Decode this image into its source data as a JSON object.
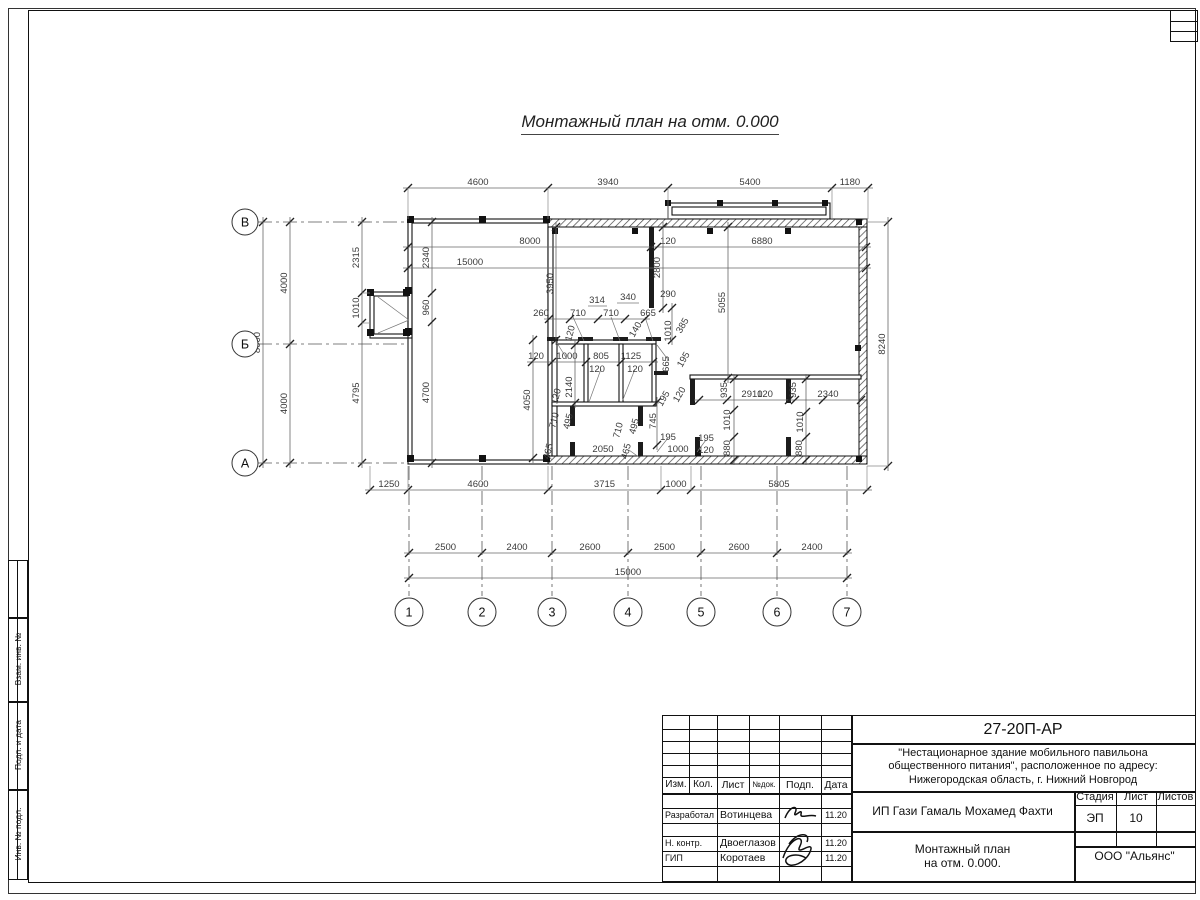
{
  "colors": {
    "line": "#111111",
    "dim_text": "#3a3a3a",
    "paper": "#ffffff"
  },
  "plan": {
    "title": "Монтажный план на отм. 0.000",
    "row_axes": [
      {
        "t": "В",
        "y": 222
      },
      {
        "t": "Б",
        "y": 344
      },
      {
        "t": "А",
        "y": 463
      }
    ],
    "col_axes": [
      {
        "t": "1",
        "x": 409
      },
      {
        "t": "2",
        "x": 482
      },
      {
        "t": "3",
        "x": 552
      },
      {
        "t": "4",
        "x": 628
      },
      {
        "t": "5",
        "x": 701
      },
      {
        "t": "6",
        "x": 777
      },
      {
        "t": "7",
        "x": 847
      }
    ],
    "chains": [
      {
        "o": "h",
        "y": 188,
        "x": [
          408,
          548,
          668,
          832,
          868
        ],
        "t": [
          "4600",
          "3940",
          "5400",
          "1180"
        ],
        "e": 31
      },
      {
        "o": "h",
        "y": 247,
        "x": [
          408,
          651,
          657,
          866
        ],
        "t": [
          "8000",
          "120",
          "6880"
        ],
        "lx": [
          530,
          668,
          762
        ]
      },
      {
        "o": "h",
        "y": 268,
        "x": [
          408,
          866
        ],
        "t": [
          "15000"
        ],
        "lx": [
          470
        ]
      },
      {
        "o": "h",
        "y": 490,
        "x": [
          370,
          408,
          548,
          661,
          691,
          867
        ],
        "t": [
          "1250",
          "4600",
          "3715",
          "1000",
          "5805"
        ],
        "e": -24
      },
      {
        "o": "h",
        "y": 553,
        "x": [
          409,
          482,
          552,
          628,
          701,
          777,
          847
        ],
        "t": [
          "2500",
          "2400",
          "2600",
          "2500",
          "2600",
          "2400"
        ]
      },
      {
        "o": "h",
        "y": 578,
        "x": [
          409,
          847
        ],
        "t": [
          "15000"
        ]
      },
      {
        "o": "h",
        "y": 319,
        "x": [
          549,
          570,
          598,
          625,
          645
        ],
        "t": [
          "260",
          "710",
          "710",
          "665"
        ],
        "lx": [
          541,
          578,
          611,
          648
        ]
      },
      {
        "o": "h",
        "y": 362,
        "x": [
          532,
          552,
          586,
          621,
          653
        ],
        "t": [
          "120",
          "1000",
          "805",
          "1125"
        ],
        "lx": [
          536,
          567,
          601,
          631
        ]
      },
      {
        "o": "h",
        "y": 400,
        "x": [
          699,
          727,
          789,
          795,
          823,
          861
        ],
        "t": [
          "",
          "2910",
          "120",
          "",
          "2340"
        ],
        "lx": [
          0,
          752,
          765,
          0,
          828
        ]
      },
      {
        "o": "v",
        "x": 290,
        "y": [
          222,
          344,
          463
        ],
        "t": [
          "4000",
          "4000"
        ]
      },
      {
        "o": "v",
        "x": 263,
        "y": [
          222,
          463
        ],
        "t": [
          "8000"
        ]
      },
      {
        "o": "v",
        "x": 362,
        "y": [
          222,
          293,
          323,
          463
        ],
        "t": [
          "2315",
          "1010",
          "4795"
        ],
        "e": 8
      },
      {
        "o": "v",
        "x": 432,
        "y": [
          222,
          293,
          322,
          463
        ],
        "t": [
          "2340",
          "960",
          "4700"
        ]
      },
      {
        "o": "v",
        "x": 888,
        "y": [
          222,
          466
        ],
        "t": [
          "8240"
        ],
        "e": -21
      },
      {
        "o": "v",
        "x": 556,
        "y": [
          227,
          340
        ],
        "t": [
          "3950"
        ]
      },
      {
        "o": "v",
        "x": 663,
        "y": [
          227,
          308
        ],
        "t": [
          "2800"
        ]
      },
      {
        "o": "v",
        "x": 728,
        "y": [
          227,
          378
        ],
        "t": [
          "5055"
        ]
      },
      {
        "o": "v",
        "x": 734,
        "y": [
          379,
          410,
          437,
          460
        ],
        "t": [
          "",
          "",
          ""
        ]
      },
      {
        "o": "v",
        "x": 806,
        "y": [
          379,
          412,
          437,
          460
        ],
        "t": [
          "",
          "",
          ""
        ]
      },
      {
        "o": "v",
        "x": 657,
        "y": [
          402,
          445
        ],
        "t": [
          ""
        ]
      },
      {
        "o": "v",
        "x": 533,
        "y": [
          340,
          458
        ],
        "t": [
          ""
        ]
      },
      {
        "o": "v",
        "x": 575,
        "y": [
          345,
          403
        ],
        "t": [
          ""
        ]
      },
      {
        "o": "v",
        "x": 672,
        "y": [
          308,
          340
        ],
        "t": [
          ""
        ]
      }
    ],
    "labels": [
      {
        "t": "314",
        "x": 597,
        "y": 303
      },
      {
        "t": "340",
        "x": 628,
        "y": 300
      },
      {
        "t": "290",
        "x": 668,
        "y": 297
      },
      {
        "t": "140",
        "x": 638,
        "y": 331,
        "r": -60
      },
      {
        "t": "1010",
        "x": 671,
        "y": 331,
        "r": -90
      },
      {
        "t": "385",
        "x": 685,
        "y": 327,
        "r": -60
      },
      {
        "t": "120",
        "x": 573,
        "y": 334,
        "r": -75
      },
      {
        "t": "665",
        "x": 669,
        "y": 364,
        "r": -90
      },
      {
        "t": "195",
        "x": 686,
        "y": 361,
        "r": -60
      },
      {
        "t": "120",
        "x": 597,
        "y": 372
      },
      {
        "t": "120",
        "x": 635,
        "y": 372
      },
      {
        "t": "2140",
        "x": 572,
        "y": 387,
        "r": -90
      },
      {
        "t": "120",
        "x": 559,
        "y": 397,
        "r": -75
      },
      {
        "t": "4050",
        "x": 530,
        "y": 400,
        "r": -90
      },
      {
        "t": "710",
        "x": 557,
        "y": 421,
        "r": -75
      },
      {
        "t": "495",
        "x": 571,
        "y": 422,
        "r": -75
      },
      {
        "t": "710",
        "x": 621,
        "y": 431,
        "r": -75
      },
      {
        "t": "495",
        "x": 637,
        "y": 427,
        "r": -75
      },
      {
        "t": "745",
        "x": 656,
        "y": 421,
        "r": -90
      },
      {
        "t": "195",
        "x": 666,
        "y": 400,
        "r": -60
      },
      {
        "t": "120",
        "x": 682,
        "y": 396,
        "r": -60
      },
      {
        "t": "465",
        "x": 551,
        "y": 452,
        "r": -75
      },
      {
        "t": "465",
        "x": 629,
        "y": 452,
        "r": -75
      },
      {
        "t": "2050",
        "x": 603,
        "y": 452
      },
      {
        "t": "195",
        "x": 668,
        "y": 440
      },
      {
        "t": "1000",
        "x": 678,
        "y": 452
      },
      {
        "t": "195",
        "x": 706,
        "y": 441
      },
      {
        "t": "120",
        "x": 706,
        "y": 453
      },
      {
        "t": "935",
        "x": 727,
        "y": 390,
        "r": -90
      },
      {
        "t": "935",
        "x": 796,
        "y": 390,
        "r": -90
      },
      {
        "t": "1010",
        "x": 730,
        "y": 420,
        "r": -90
      },
      {
        "t": "880",
        "x": 730,
        "y": 448,
        "r": -90
      },
      {
        "t": "1010",
        "x": 803,
        "y": 422,
        "r": -90
      },
      {
        "t": "880",
        "x": 802,
        "y": 448,
        "r": -90
      }
    ]
  },
  "sheet": {
    "doc_code": "27-20П-АР",
    "object_line1": "\"Нестационарное здание мобильного павильона",
    "object_line2": "общественного питания\", расположенное по адресу:",
    "object_line3": "Нижегородская область, г. Нижний Новгород",
    "client": "ИП Гази Гамаль Мохамед Фахти",
    "drawing_name_line1": "Монтажный план",
    "drawing_name_line2": "на отм. 0.000.",
    "company": "ООО \"Альянс\"",
    "stage_label": "Стадия",
    "sheet_label": "Лист",
    "sheets_label": "Листов",
    "stage": "ЭП",
    "sheet_no": "10",
    "sheets_total": "",
    "header_cols": [
      "Изм.",
      "Кол.",
      "Лист",
      "№док.",
      "Подп.",
      "Дата"
    ],
    "rows": [
      {
        "role": "Разработал",
        "name": "Вотинцева",
        "date": "11.20"
      },
      {
        "role": "Н. контр.",
        "name": "Двоеглазов",
        "date": "11.20"
      },
      {
        "role": "ГИП",
        "name": "Коротаев",
        "date": "11.20"
      }
    ],
    "side_labels": [
      "Взам. инв. №",
      "Подп. и дата",
      "Инв. № подл."
    ]
  }
}
